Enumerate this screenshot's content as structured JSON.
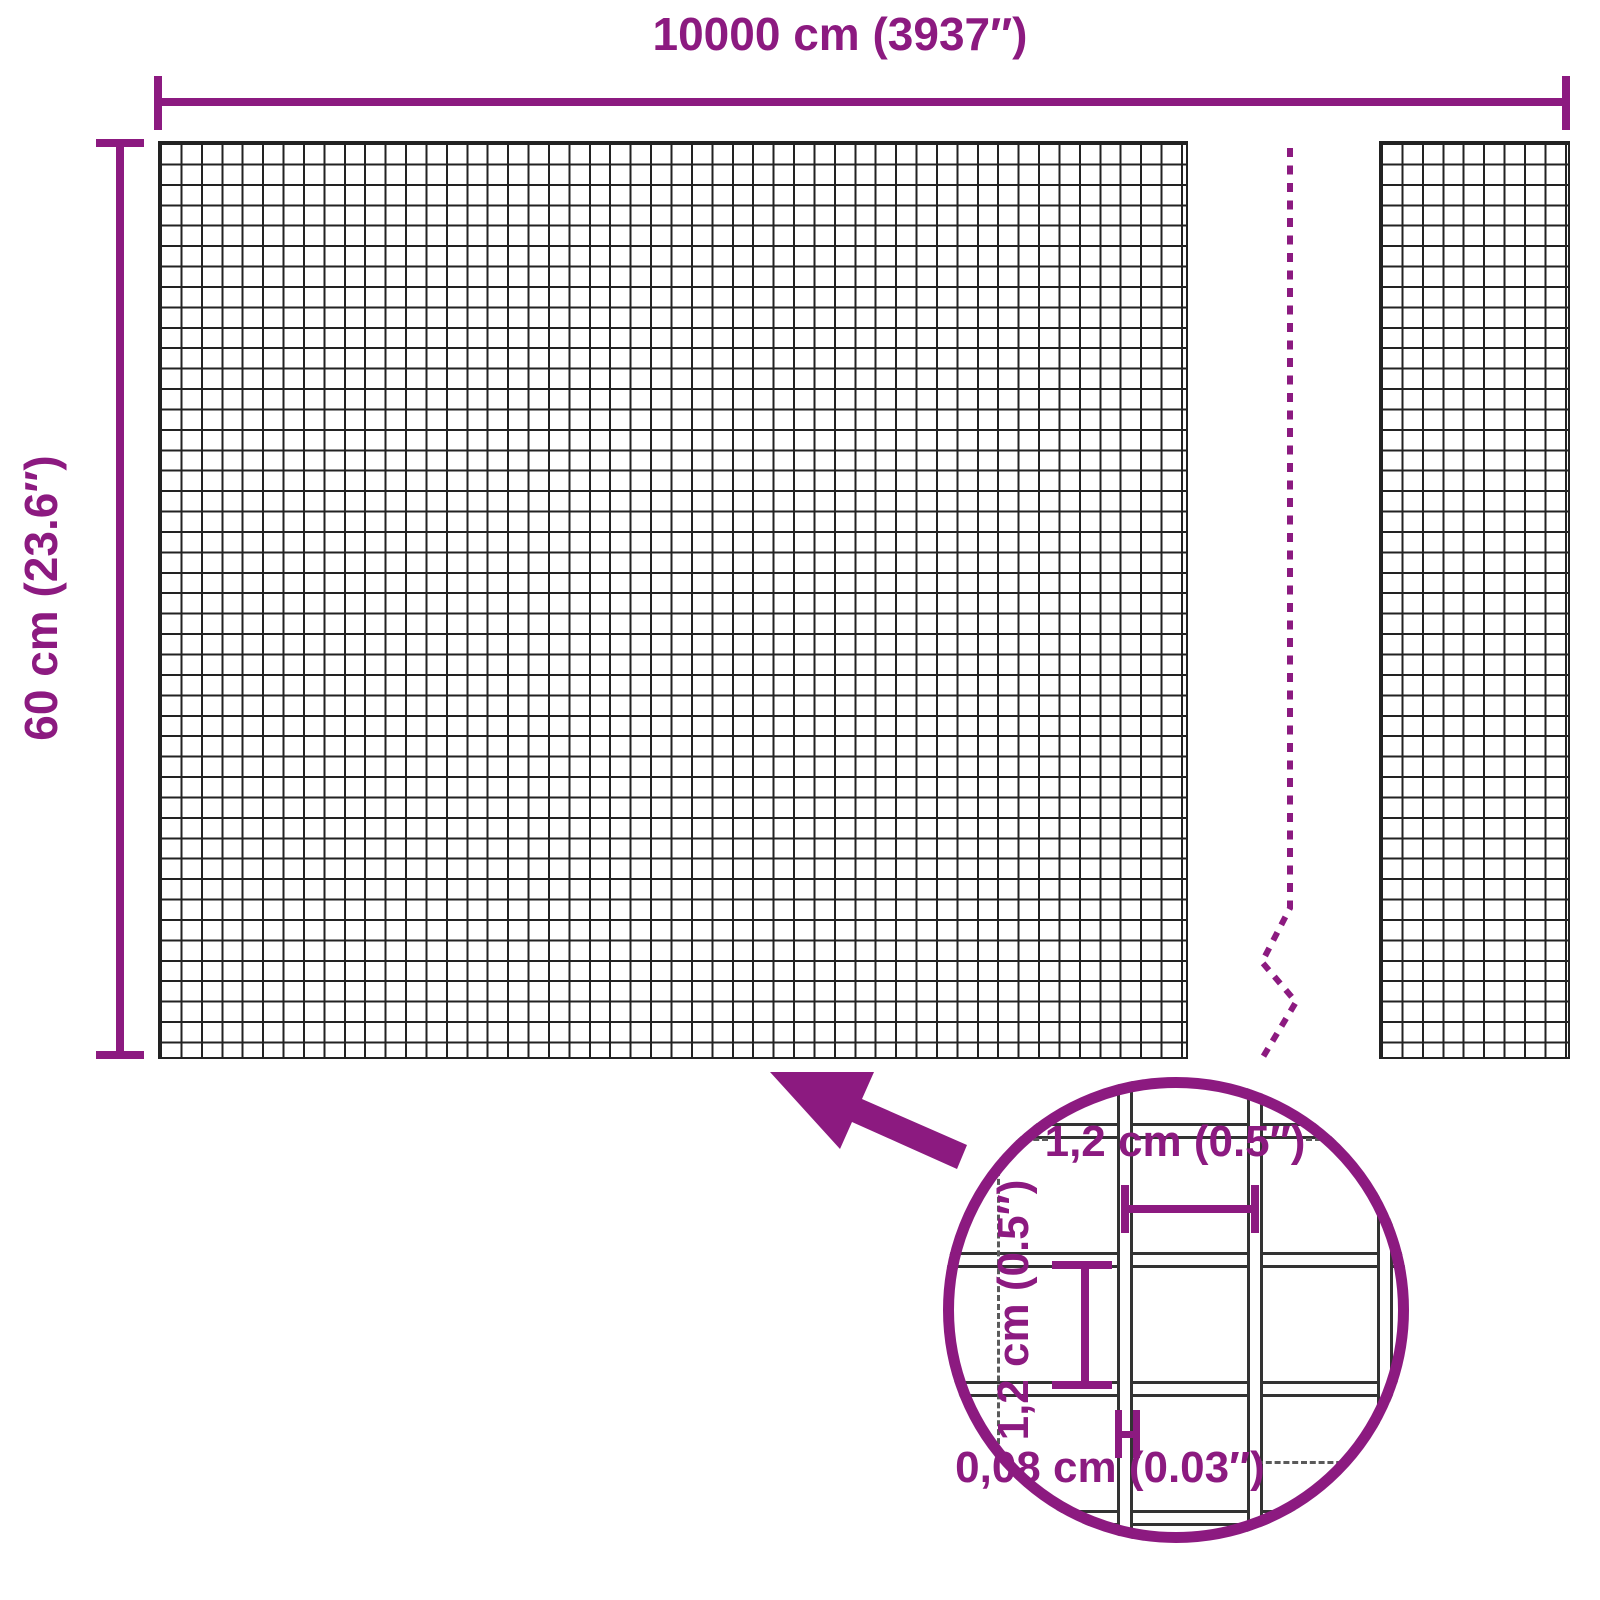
{
  "colors": {
    "accent": "#8C1A80",
    "mesh": "#222222",
    "wire": "#333333",
    "dash": "#5a5a5a"
  },
  "top_dimension": {
    "label": "10000 cm (3937″)"
  },
  "side_dimension": {
    "label": "60 cm (23.6″)"
  },
  "detail_view": {
    "opening_width_label": "1,2 cm (0.5″)",
    "opening_height_label": "1,2 cm (0.5″)",
    "wire_diameter_label": "0,08 cm (0.03″)"
  }
}
